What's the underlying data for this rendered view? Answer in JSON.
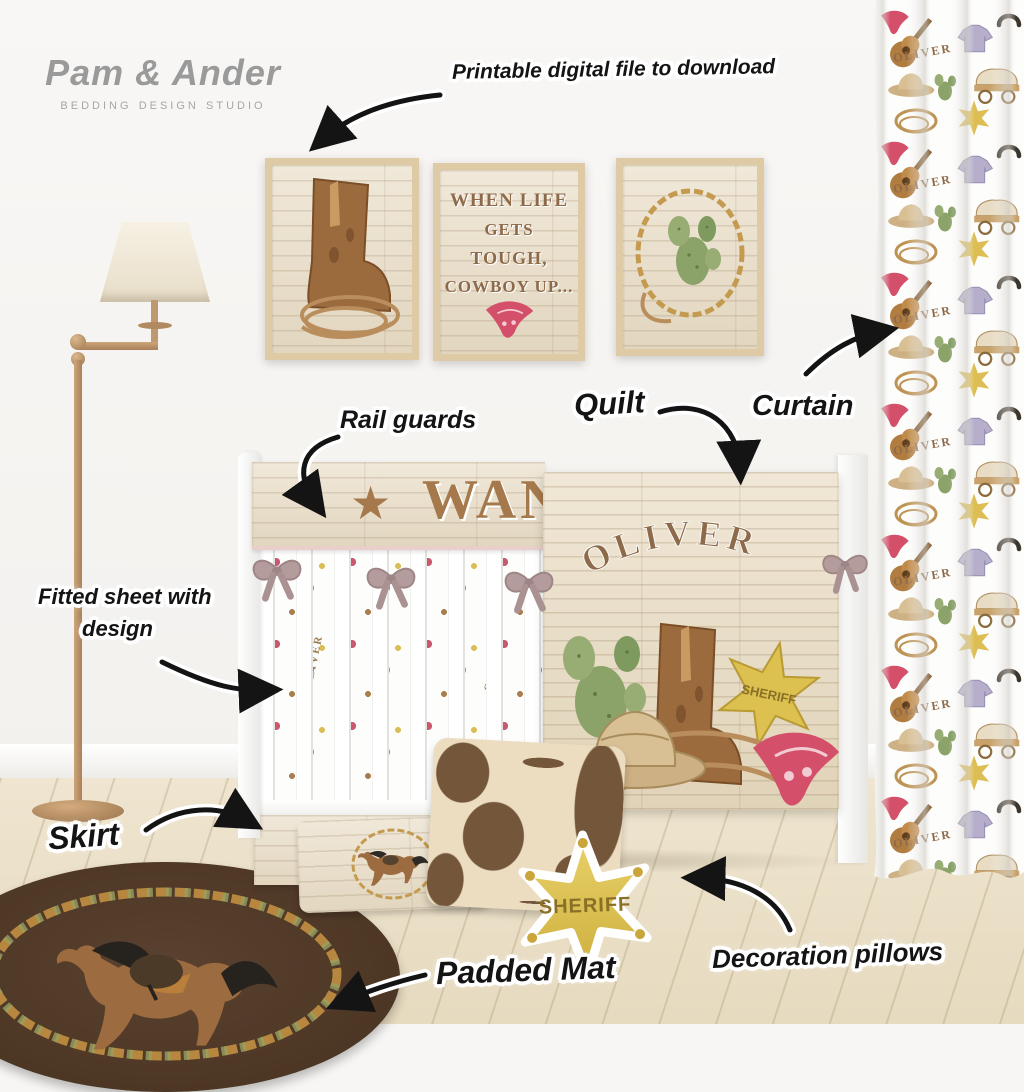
{
  "brand": {
    "name": "Pam & Ander",
    "tagline": "Bedding design studio"
  },
  "annotations": {
    "printable": "Printable digital file to download",
    "rail_guards": "Rail guards",
    "quilt": "Quilt",
    "curtain": "Curtain",
    "fitted_sheet_line1": "Fitted sheet with",
    "fitted_sheet_line2": "design",
    "skirt": "Skirt",
    "padded_mat": "Padded Mat",
    "decoration_pillows": "Decoration pillows"
  },
  "wall_art": {
    "quote_line1": "WHEN LIFE",
    "quote_line2": "GETS",
    "quote_line3": "TOUGH,",
    "quote_line4": "COWBOY UP..."
  },
  "bedding": {
    "rail_guard_word": "WANTED",
    "child_name": "OLIVER",
    "badge_text": "SHERIFF"
  },
  "curtain": {
    "name_text": "OLIVER",
    "motifs": [
      "bandana",
      "guitar",
      "denim-shirt",
      "horseshoe",
      "cowboy-hat",
      "cactus",
      "covered-wagon",
      "lasso",
      "sheriff-star"
    ]
  },
  "icons": {
    "star": "★"
  },
  "colors": {
    "accent_brown": "#8d6a4a",
    "wood_light": "#ece3d3",
    "bow_mauve": "#b49c9c",
    "star_gold": "#dcc050",
    "bandana_red": "#d4506a",
    "cactus_green": "#8ba268",
    "rug_brown": "#4f3826",
    "brass": "#c0986f",
    "ink": "#141414"
  }
}
